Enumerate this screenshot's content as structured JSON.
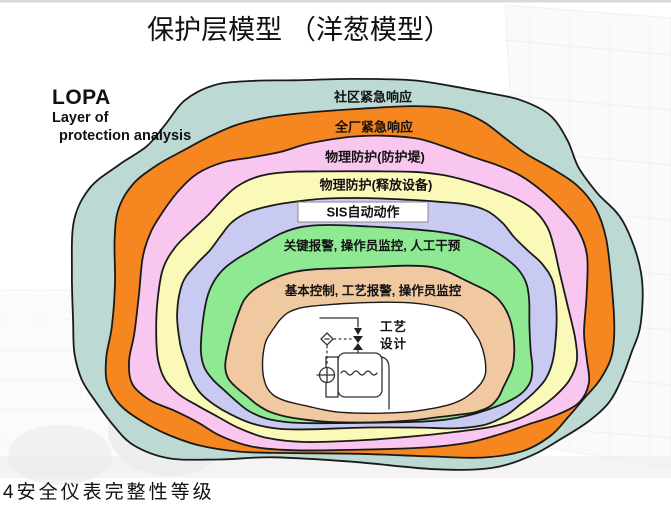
{
  "slide": {
    "title": "保护层模型 （洋葱模型）",
    "caption": "4安全仪表完整性等级",
    "lopa": {
      "abbr": "LOPA",
      "line1": "Layer of",
      "line2": "protection analysis"
    }
  },
  "onion": {
    "outline_color": "#1a1a1a",
    "layers": [
      {
        "id": "community-emergency-response",
        "label": "社区紧急响应",
        "color": "#bcd9d3"
      },
      {
        "id": "plant-emergency-response",
        "label": "全厂紧急响应",
        "color": "#f6861f"
      },
      {
        "id": "physical-protection-dike",
        "label": "物理防护(防护堤)",
        "color": "#f9c6ef"
      },
      {
        "id": "physical-protection-relief-devices",
        "label": "物理防护(释放设备)",
        "color": "#fbf9b8"
      },
      {
        "id": "sis-automatic-action",
        "label": "SIS自动动作",
        "color": "#c9caf2"
      },
      {
        "id": "critical-alarm-operator-intervention",
        "label": "关键报警, 操作员监控, 人工干预",
        "color": "#8fe993"
      },
      {
        "id": "basic-control-process-alarms",
        "label": "基本控制, 工艺报警, 操作员监控",
        "color": "#f0c9a0"
      },
      {
        "id": "process-design",
        "label": "工艺设计",
        "color": "#ffffff"
      }
    ]
  }
}
